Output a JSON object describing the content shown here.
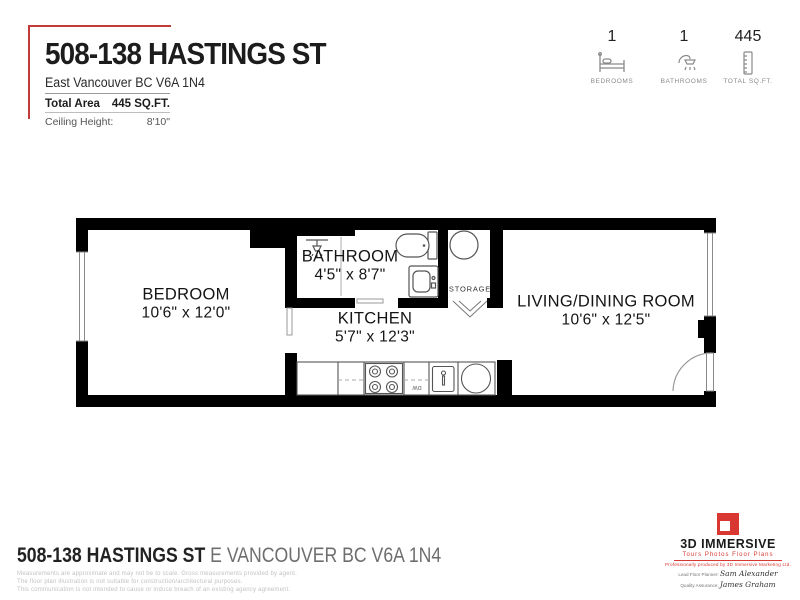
{
  "header": {
    "title": "508-138 HASTINGS ST",
    "address": "East Vancouver BC V6A 1N4",
    "total_area_label": "Total Area",
    "total_area_value": "445 SQ.FT.",
    "ceiling_height_label": "Ceiling Height:",
    "ceiling_height_value": "8'10\"",
    "accent_color": "#c23b38"
  },
  "stats": {
    "items": [
      {
        "value": "1",
        "label": "BEDROOMS",
        "icon": "bed-icon"
      },
      {
        "value": "1",
        "label": "BATHROOMS",
        "icon": "shower-icon"
      },
      {
        "value": "445",
        "label": "TOTAL SQ.FT.",
        "icon": "ruler-icon"
      }
    ]
  },
  "floorplan": {
    "rooms": [
      {
        "name": "BEDROOM",
        "dimensions": "10'6\" x 12'0\""
      },
      {
        "name": "BATHROOM",
        "dimensions": "4'5\" x 8'7\""
      },
      {
        "name": "KITCHEN",
        "dimensions": "5'7\" x 12'3\""
      },
      {
        "name": "STORAGE",
        "dimensions": ""
      },
      {
        "name": "LIVING/DINING ROOM",
        "dimensions": "10'6\" x 12'5\""
      }
    ],
    "labels": {
      "dishwasher": "DW"
    },
    "fixtures": [
      "shower-head",
      "toilet",
      "bathroom-sink",
      "water-tank",
      "refrigerator",
      "stove",
      "dishwasher",
      "kitchen-sink",
      "round-sink",
      "entry-door",
      "windows"
    ],
    "wall_color": "#000000"
  },
  "footer": {
    "address_bold": "508-138 HASTINGS ST",
    "address_light": "E VANCOUVER BC V6A 1N4",
    "disclaimer_lines": [
      "Measurements are approximate and may not be to scale. Gross measurements provided by agent.",
      "The floor plan illustration is not suitable for construction/architectural purposes.",
      "This communication is not intended to cause or induce breach of an existing agency agreement."
    ],
    "logo": {
      "name": "3D IMMERSIVE",
      "tagline": "Tours   Photos   Floor Plans",
      "produced_by": "Professionally produced by 3D Immersive Marketing Ltd.",
      "lead_label": "Lead Floor Planner:",
      "lead_signature": "Sam Alexander",
      "qa_label": "Quality Assurance:",
      "qa_signature": "James Graham",
      "brand_color": "#d93832"
    }
  }
}
